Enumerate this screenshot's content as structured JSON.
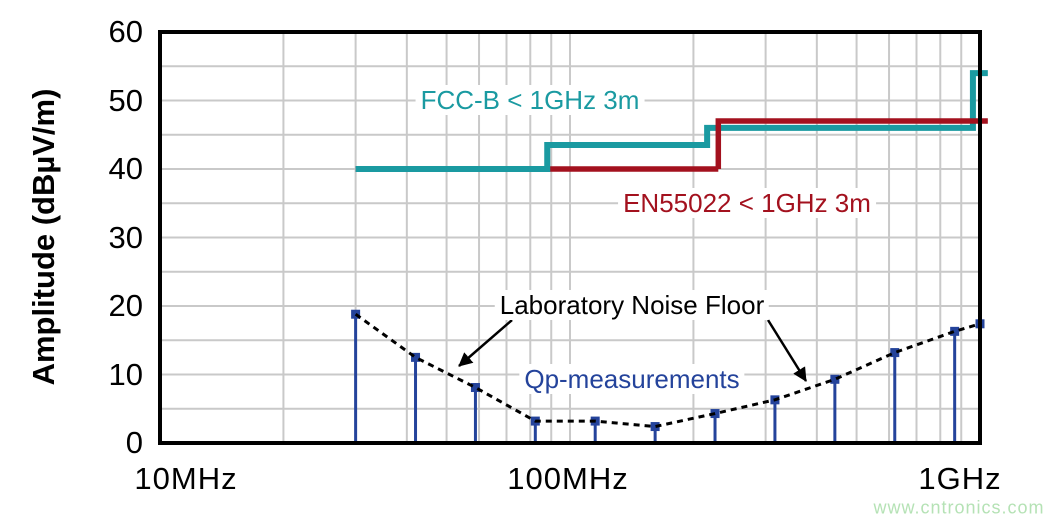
{
  "chart_data": {
    "type": "line+stem",
    "title": "",
    "x_axis": {
      "scale": "log",
      "unit": "MHz",
      "range_mhz": [
        10,
        1000
      ],
      "ticks": [
        {
          "mhz": 10,
          "label": "10MHz"
        },
        {
          "mhz": 100,
          "label": "100MHz"
        },
        {
          "mhz": 1000,
          "label": "1GHz"
        }
      ],
      "minor_gridlines_mhz": [
        20,
        30,
        40,
        50,
        60,
        70,
        80,
        90,
        100,
        200,
        300,
        400,
        500,
        600,
        700,
        800,
        900
      ]
    },
    "y_axis": {
      "title": "Amplitude (dBµV/m)",
      "range": [
        0,
        60
      ],
      "major_ticks": [
        0,
        10,
        20,
        30,
        40,
        50,
        60
      ],
      "gridline_step": 5
    },
    "grid": {
      "on": true,
      "color": "#c9c9c9"
    },
    "series": [
      {
        "name": "FCC-B < 1GHz 3m",
        "type": "step-line",
        "color": "#1a9aa1",
        "points_mhz_dbuv": [
          [
            30,
            40
          ],
          [
            88,
            40
          ],
          [
            88,
            43.5
          ],
          [
            216,
            43.5
          ],
          [
            216,
            46
          ],
          [
            961,
            46
          ],
          [
            961,
            54
          ],
          [
            1045,
            54
          ]
        ]
      },
      {
        "name": "EN55022 < 1GHz 3m",
        "type": "step-line",
        "color": "#a3111e",
        "points_mhz_dbuv": [
          [
            30,
            40
          ],
          [
            230,
            40
          ],
          [
            230,
            47
          ],
          [
            1045,
            47
          ]
        ]
      },
      {
        "name": "Laboratory Noise Floor",
        "type": "dashed-line",
        "color": "#000000",
        "points_mhz_dbuv": [
          [
            30,
            18.8
          ],
          [
            42,
            12.5
          ],
          [
            58.8,
            8.1
          ],
          [
            82.3,
            3.2
          ],
          [
            115.2,
            3.2
          ],
          [
            161.3,
            2.4
          ],
          [
            225.8,
            4.3
          ],
          [
            316.1,
            6.3
          ],
          [
            442.6,
            9.3
          ],
          [
            619.6,
            13.2
          ],
          [
            867.4,
            16.3
          ],
          [
            1000,
            17.4
          ]
        ]
      },
      {
        "name": "Qp-measurements",
        "type": "stem",
        "color": "#24439b",
        "points_mhz_dbuv": [
          [
            30,
            18.8
          ],
          [
            42,
            12.5
          ],
          [
            58.8,
            8.1
          ],
          [
            82.3,
            3.2
          ],
          [
            115.2,
            3.2
          ],
          [
            161.3,
            2.4
          ],
          [
            225.8,
            4.3
          ],
          [
            316.1,
            6.3
          ],
          [
            442.6,
            9.3
          ],
          [
            619.6,
            13.2
          ],
          [
            867.4,
            16.3
          ]
        ],
        "end_marker_mhz_dbuv": [
          1000,
          17.4
        ]
      }
    ],
    "annotation_arrows": [
      {
        "from_px": [
          512,
          320
        ],
        "to_px": [
          459,
          366
        ]
      },
      {
        "from_px": [
          768,
          320
        ],
        "to_px": [
          806,
          381
        ]
      }
    ],
    "frame_color": "#000000"
  },
  "watermark": "www.cntronics.com"
}
